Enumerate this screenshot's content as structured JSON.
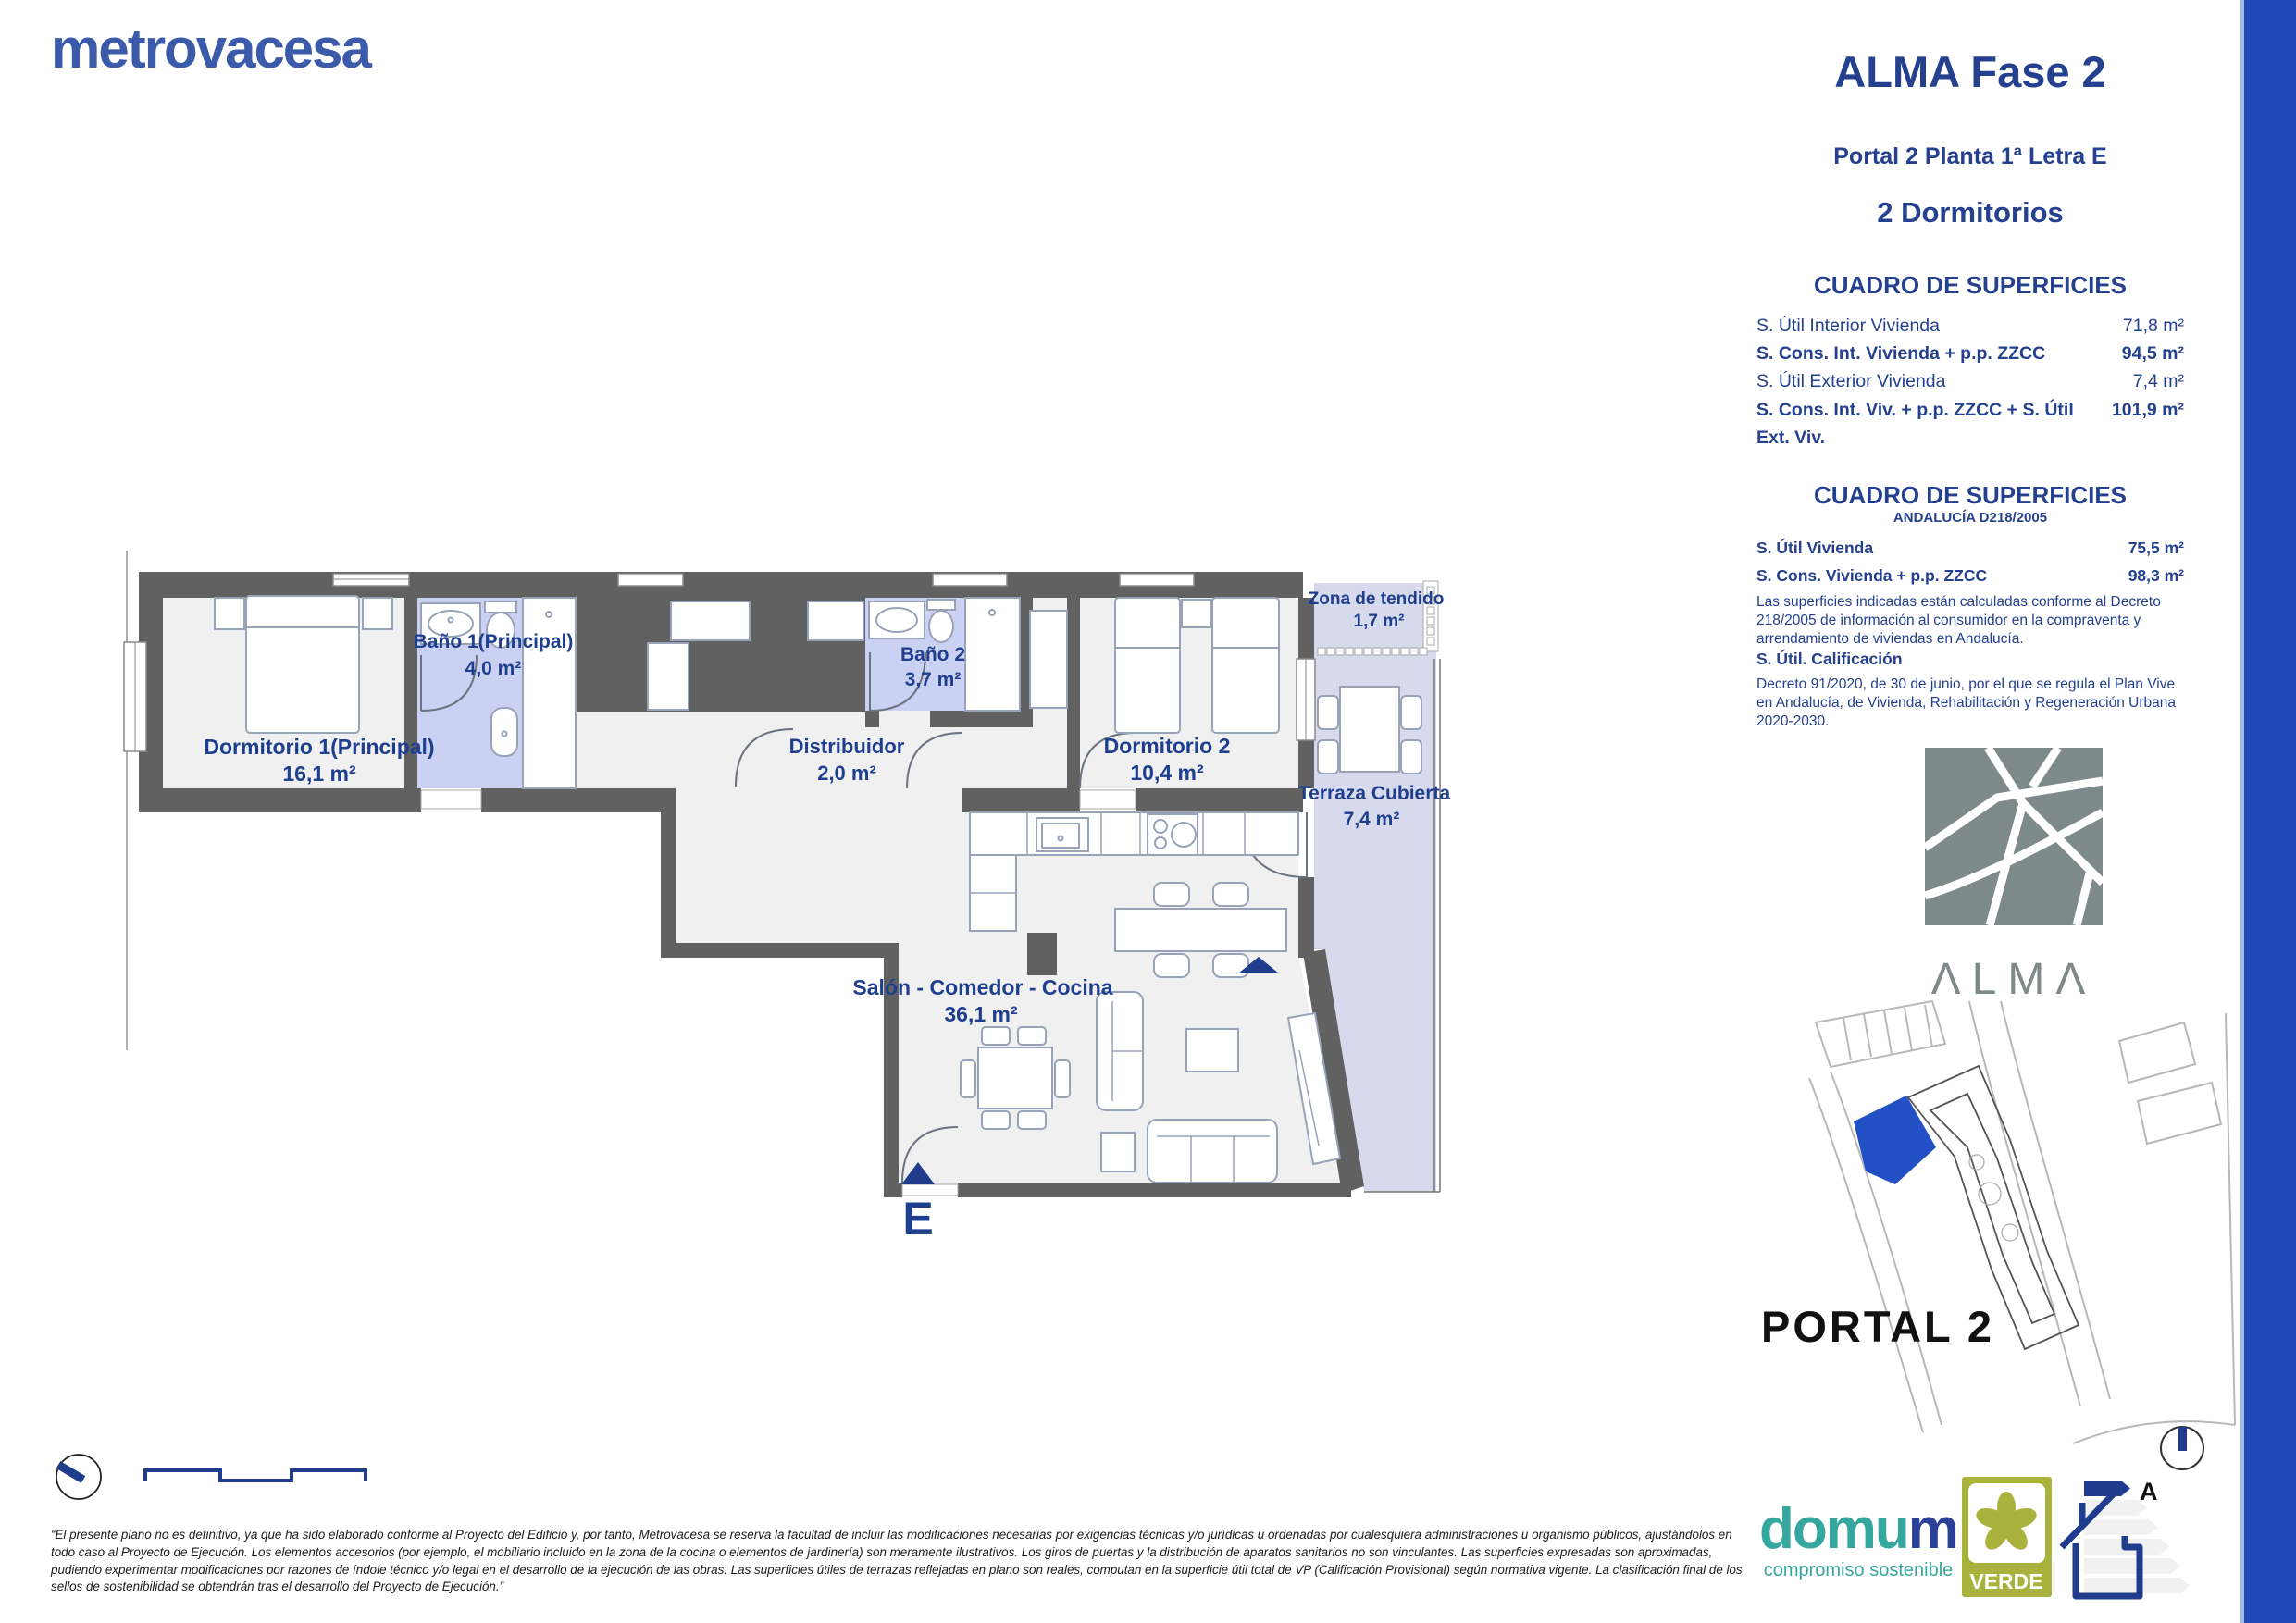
{
  "brand": {
    "logo_text": "metrovacesa",
    "color": "#3b5aa9"
  },
  "header": {
    "title": "ALMA Fase 2",
    "subtitle": "Portal 2 Planta 1ª Letra E",
    "type_label": "2 Dormitorios"
  },
  "surfaces_table": {
    "title": "CUADRO DE SUPERFICIES",
    "rows": [
      {
        "label": "S. Útil Interior Vivienda",
        "value": "71,8 m²",
        "bold": false
      },
      {
        "label": "S. Cons. Int. Vivienda + p.p. ZZCC",
        "value": "94,5 m²",
        "bold": true
      },
      {
        "label": "S. Útil Exterior Vivienda",
        "value": "7,4 m²",
        "bold": false
      },
      {
        "label": "S. Cons. Int. Viv. + p.p. ZZCC + S. Útil Ext. Viv.",
        "value": "101,9 m²",
        "bold": true
      }
    ]
  },
  "surfaces_table_andalucia": {
    "title": "CUADRO DE SUPERFICIES",
    "subtitle": "ANDALUCÍA D218/2005",
    "rows": [
      {
        "label": "S. Útil Vivienda",
        "value": "75,5 m²"
      },
      {
        "label": "S. Cons. Vivienda + p.p. ZZCC",
        "value": "98,3 m²"
      }
    ],
    "note": "Las superficies indicadas están calculadas conforme al Decreto 218/2005 de información al consumidor en la compraventa y arrendamiento de viviendas en Andalucía.",
    "calificacion_label": "S. Útil. Calificación",
    "calificacion_note": "Decreto 91/2020, de 30 de junio, por el que se regula el Plan Vive en Andalucía, de Vivienda, Rehabilitación y Regeneración Urbana 2020-2030."
  },
  "alma_logo": {
    "wordmark": "ΛLMΛ"
  },
  "site_plan": {
    "portal_label": "PORTAL 2"
  },
  "floorplan": {
    "entrance_label": "E",
    "rooms": [
      {
        "name": "Dormitorio 1(Principal)",
        "area": "16,1 m²"
      },
      {
        "name": "Baño 1(Principal)",
        "area": "4,0 m²"
      },
      {
        "name": "Distribuidor",
        "area": "2,0 m²"
      },
      {
        "name": "Baño 2",
        "area": "3,7 m²"
      },
      {
        "name": "Dormitorio 2",
        "area": "10,4 m²"
      },
      {
        "name": "Zona de tendido",
        "area": "1,7 m²"
      },
      {
        "name": "Terraza Cubierta",
        "area": "7,4 m²"
      },
      {
        "name": "Salón - Comedor - Cocina",
        "area": "36,1 m²"
      }
    ]
  },
  "footer": {
    "disclaimer": "“El presente plano no es definitivo, ya que ha sido elaborado conforme al Proyecto del Edificio y, por tanto, Metrovacesa se reserva la facultad de incluir las modificaciones necesarias por exigencias técnicas y/o jurídicas u ordenadas por cualesquiera administraciones u organismo públicos, ajustándolos en todo caso al Proyecto de Ejecución. Los elementos accesorios (por ejemplo, el mobiliario incluido en la zona de la cocina o elementos de jardinería) son meramente ilustrativos. Los giros de puertas y la distribución de aparatos sanitarios no son vinculantes. Las superficies expresadas son aproximadas, pudiendo experimentar modificaciones por razones de índole técnico y/o legal en el desarrollo de la ejecución de las obras. Las superficies útiles de terrazas reflejadas en plano son reales, computan en la superficie útil total de VP (Calificación Provisional) según normativa vigente. La clasificación final de los sellos de sostenibilidad se obtendrán tras el desarrollo del Proyecto de Ejecución.”",
    "domum": {
      "word_main": "domu",
      "word_accent": "m",
      "tagline": "compromiso sostenible"
    },
    "verde": {
      "label": "VERDE"
    },
    "energy": {
      "rating": "A"
    }
  },
  "colors": {
    "navy_text": "#24408e",
    "accent_bar": "#2148b8",
    "wall_gray": "#616161",
    "bath_lavender": "#cbd1f2",
    "terrace_lavender": "#d6daec",
    "alma_gray": "#7e8989",
    "verde_olive": "#a9b23c",
    "domum_teal": "#36a79e",
    "site_highlight_blue": "#2351c5"
  }
}
